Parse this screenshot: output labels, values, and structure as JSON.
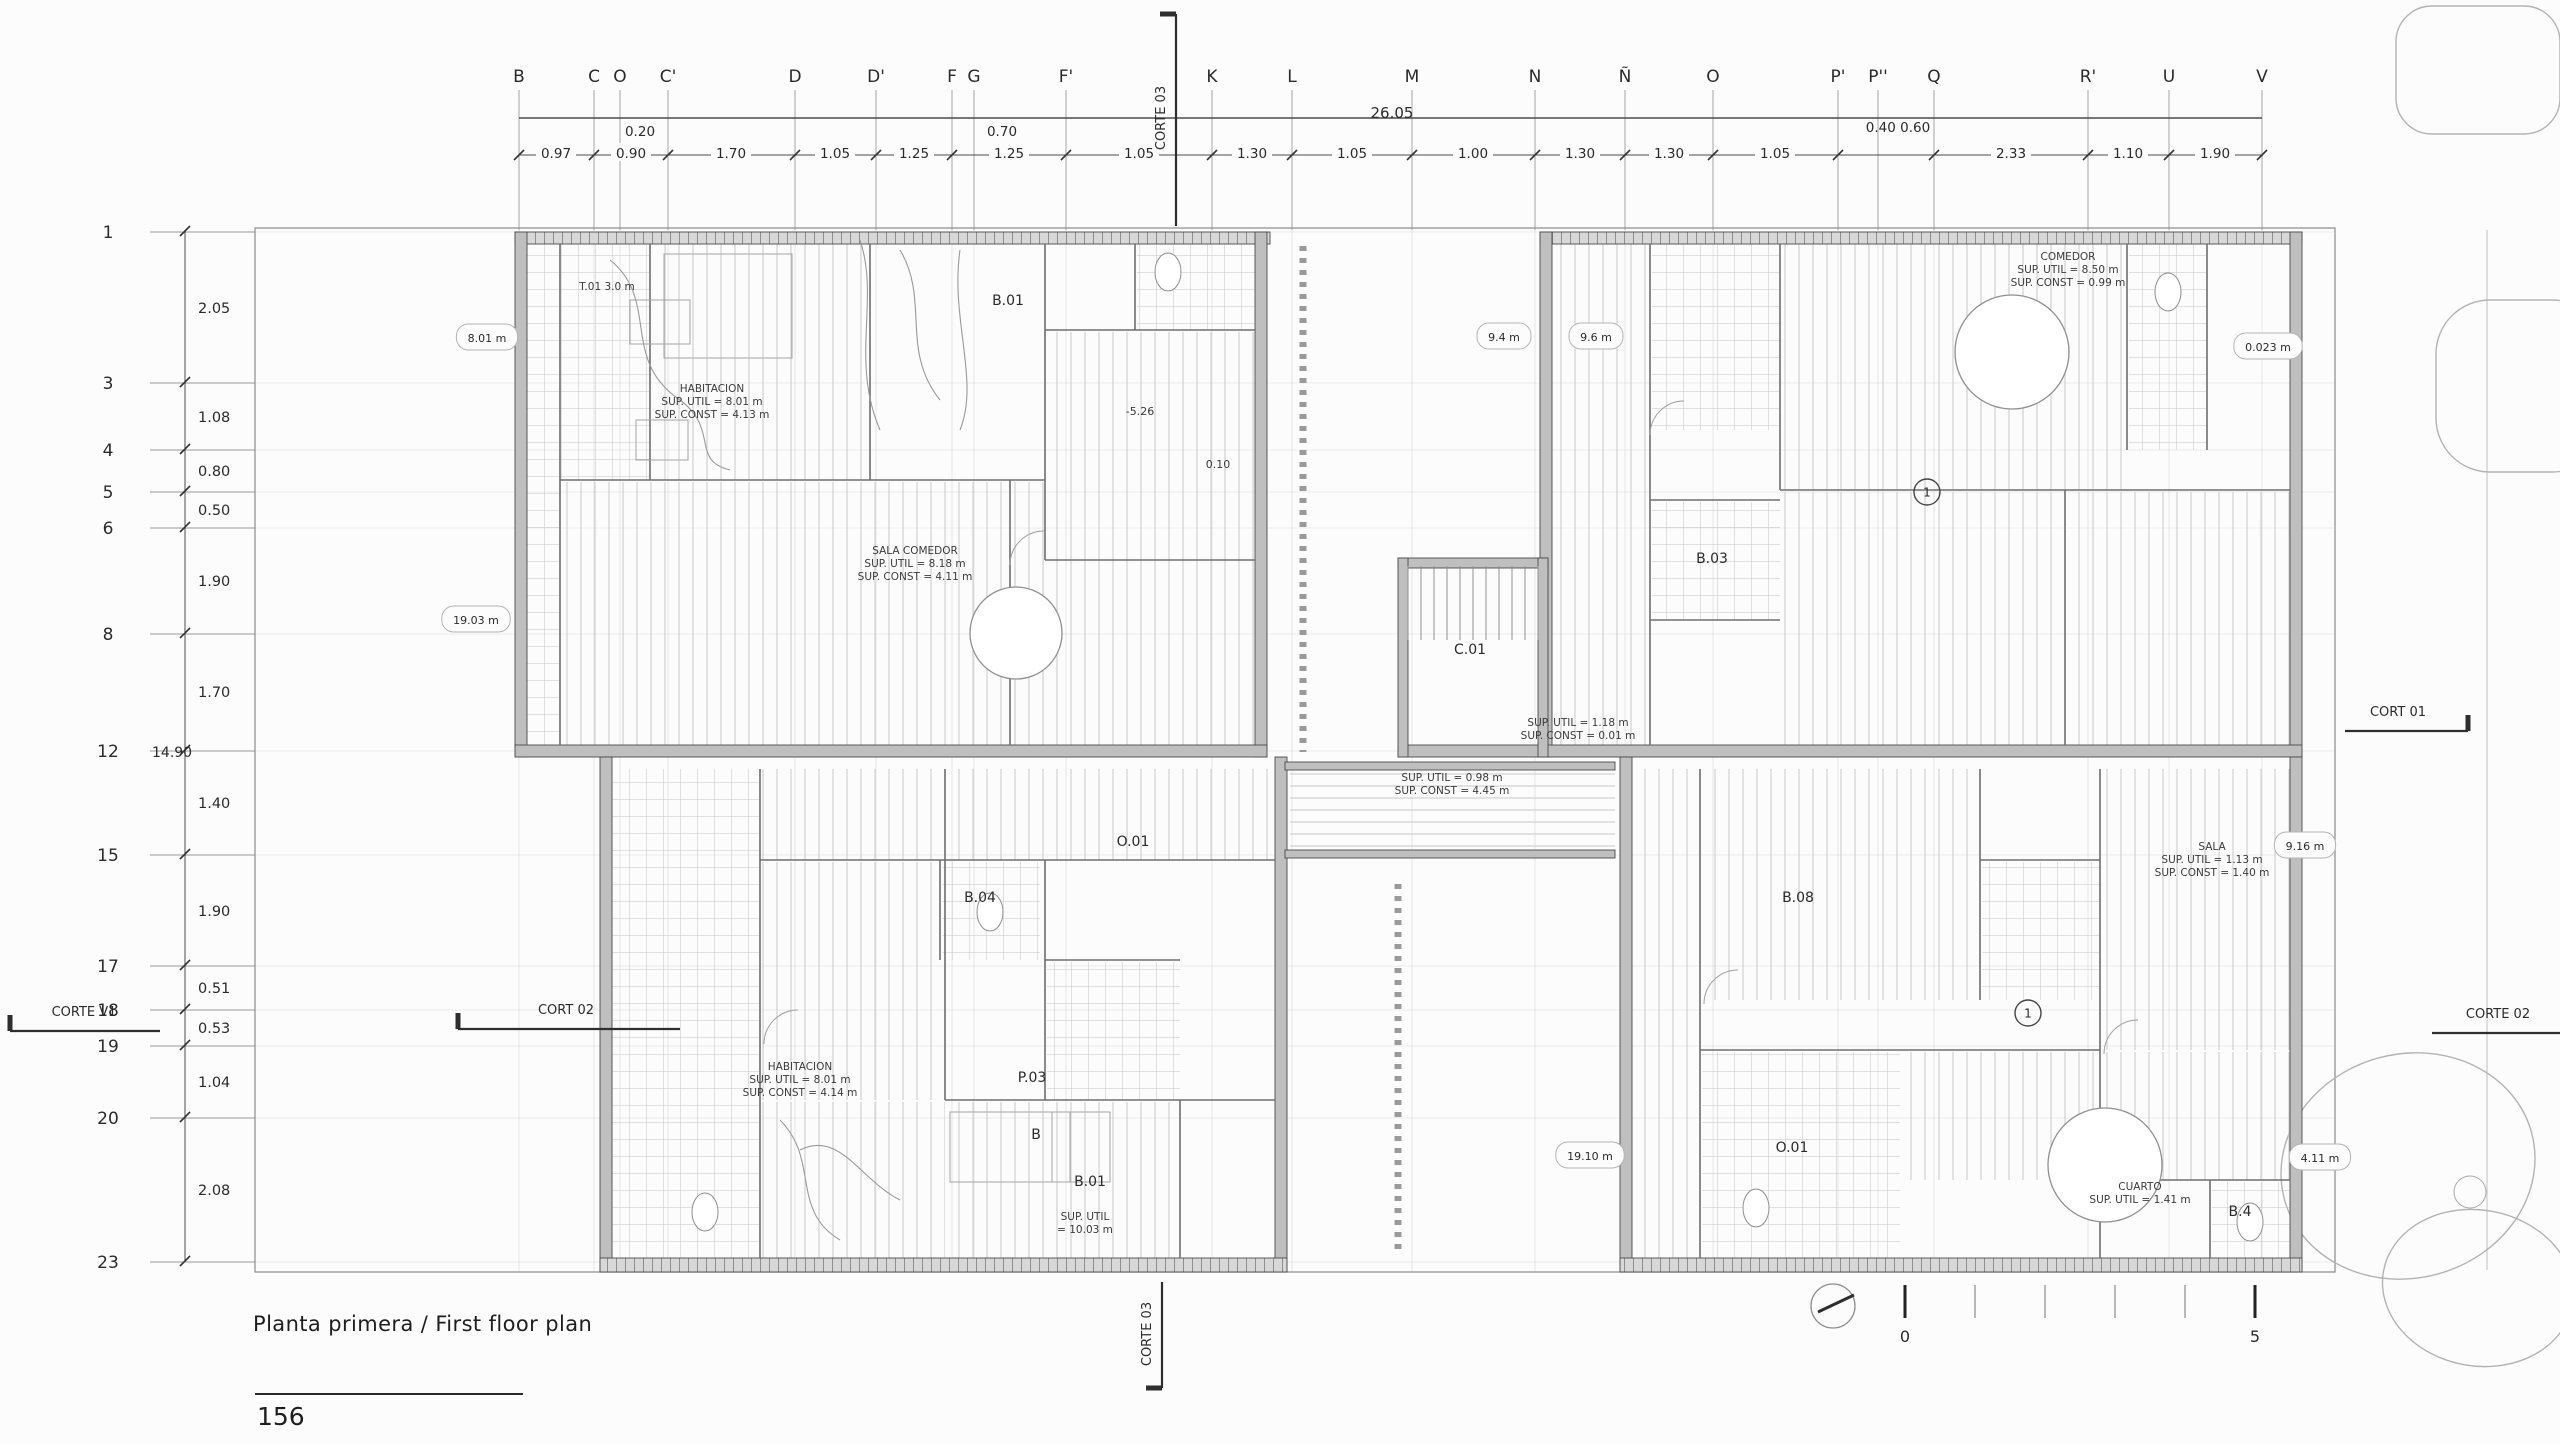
{
  "sheet": {
    "title": "Planta primera / First floor plan",
    "page_number": "156"
  },
  "top_grid": {
    "letters": [
      {
        "label": "B",
        "x": 519
      },
      {
        "label": "C",
        "x": 594
      },
      {
        "label": "O",
        "x": 620
      },
      {
        "label": "C'",
        "x": 668
      },
      {
        "label": "D",
        "x": 795
      },
      {
        "label": "D'",
        "x": 876
      },
      {
        "label": "F",
        "x": 952
      },
      {
        "label": "G",
        "x": 974
      },
      {
        "label": "F'",
        "x": 1066
      },
      {
        "label": "K",
        "x": 1212
      },
      {
        "label": "L",
        "x": 1292
      },
      {
        "label": "M",
        "x": 1412
      },
      {
        "label": "N",
        "x": 1535
      },
      {
        "label": "Ñ",
        "x": 1625
      },
      {
        "label": "O",
        "x": 1713
      },
      {
        "label": "P'",
        "x": 1838
      },
      {
        "label": "P''",
        "x": 1878
      },
      {
        "label": "Q",
        "x": 1934
      },
      {
        "label": "R'",
        "x": 2088
      },
      {
        "label": "U",
        "x": 2169
      },
      {
        "label": "V",
        "x": 2262
      }
    ],
    "total_dim": {
      "text": "26.05",
      "x": 1392,
      "y": 122
    },
    "sub_dims": [
      {
        "text": "0.20",
        "x": 640,
        "y": 136
      },
      {
        "text": "0.70",
        "x": 1002,
        "y": 136
      },
      {
        "text": "0.40 0.60",
        "x": 1898,
        "y": 132
      }
    ],
    "tick_xs": [
      519,
      594,
      668,
      795,
      876,
      952,
      1066,
      1212,
      1292,
      1412,
      1535,
      1625,
      1713,
      1838,
      1934,
      2088,
      2169,
      2262
    ],
    "chain": [
      {
        "text": "0.97",
        "x": 556
      },
      {
        "text": "0.90",
        "x": 631
      },
      {
        "text": "1.70",
        "x": 731
      },
      {
        "text": "1.05",
        "x": 835
      },
      {
        "text": "1.25",
        "x": 914
      },
      {
        "text": "1.25",
        "x": 1009
      },
      {
        "text": "1.05",
        "x": 1139
      },
      {
        "text": "1.30",
        "x": 1252
      },
      {
        "text": "1.05",
        "x": 1352
      },
      {
        "text": "1.00",
        "x": 1473
      },
      {
        "text": "1.30",
        "x": 1580
      },
      {
        "text": "1.30",
        "x": 1669
      },
      {
        "text": "1.05",
        "x": 1775
      },
      {
        "text": "2.33",
        "x": 2011
      },
      {
        "text": "1.10",
        "x": 2128
      },
      {
        "text": "1.90",
        "x": 2215
      }
    ]
  },
  "left_grid": {
    "rows": [
      {
        "label": "1",
        "y": 232
      },
      {
        "label": "3",
        "y": 383
      },
      {
        "label": "4",
        "y": 450
      },
      {
        "label": "5",
        "y": 492
      },
      {
        "label": "6",
        "y": 528
      },
      {
        "label": "8",
        "y": 634
      },
      {
        "label": "12",
        "y": 751
      },
      {
        "label": "15",
        "y": 855
      },
      {
        "label": "17",
        "y": 966
      },
      {
        "label": "18",
        "y": 1010
      },
      {
        "label": "19",
        "y": 1046
      },
      {
        "label": "20",
        "y": 1118
      },
      {
        "label": "23",
        "y": 1262
      }
    ],
    "total": {
      "text": "14.90",
      "x": 152,
      "y": 751
    },
    "dims": [
      {
        "text": "2.05",
        "y": 308
      },
      {
        "text": "1.08",
        "y": 417
      },
      {
        "text": "0.80",
        "y": 471
      },
      {
        "text": "0.50",
        "y": 510
      },
      {
        "text": "1.90",
        "y": 581
      },
      {
        "text": "1.70",
        "y": 692
      },
      {
        "text": "1.40",
        "y": 803
      },
      {
        "text": "1.90",
        "y": 911
      },
      {
        "text": "0.51",
        "y": 988
      },
      {
        "text": "0.53",
        "y": 1028
      },
      {
        "text": "1.04",
        "y": 1082
      },
      {
        "text": "2.08",
        "y": 1190
      }
    ]
  },
  "sections": [
    {
      "id": "corte-03-top",
      "label": "CORTE 03",
      "type": "vertical",
      "x": 1176,
      "y1": 14,
      "y2": 226,
      "tick": "top",
      "tx": 1165,
      "ty": 118
    },
    {
      "id": "corte-03-bottom",
      "label": "CORTE 03",
      "type": "vertical",
      "x": 1162,
      "y1": 1282,
      "y2": 1388,
      "tick": "bottom",
      "tx": 1151,
      "ty": 1334
    },
    {
      "id": "cort-01-right",
      "label": "CORT 01",
      "type": "horizontal",
      "y": 731,
      "x1": 2345,
      "x2": 2468,
      "tick": "right",
      "tx": 2398,
      "ty": 716
    },
    {
      "id": "cort-02-left",
      "label": "CORT 02",
      "type": "horizontal",
      "y": 1029,
      "x1": 458,
      "x2": 680,
      "tick": "left",
      "tx": 566,
      "ty": 1014
    },
    {
      "id": "corte-v1-left",
      "label": "CORTE V1",
      "type": "horizontal",
      "y": 1031,
      "x1": 10,
      "x2": 160,
      "tick": "left",
      "tx": 84,
      "ty": 1016
    },
    {
      "id": "corte-02-right",
      "label": "CORTE 02",
      "type": "horizontal",
      "y": 1033,
      "x1": 2432,
      "x2": 2560,
      "tick": "none",
      "tx": 2498,
      "ty": 1018
    }
  ],
  "annotations": {
    "room_codes": [
      {
        "text": "B.01",
        "x": 1008,
        "y": 305
      },
      {
        "text": "B.03",
        "x": 1712,
        "y": 563
      },
      {
        "text": "C.01",
        "x": 1470,
        "y": 654
      },
      {
        "text": "B.04",
        "x": 980,
        "y": 902
      },
      {
        "text": "O.01",
        "x": 1133,
        "y": 846
      },
      {
        "text": "B.08",
        "x": 1798,
        "y": 902
      },
      {
        "text": "B.01",
        "x": 1090,
        "y": 1186
      },
      {
        "text": "P.03",
        "x": 1032,
        "y": 1082
      },
      {
        "text": "O.01",
        "x": 1792,
        "y": 1152
      },
      {
        "text": "B",
        "x": 1036,
        "y": 1139
      },
      {
        "text": "B.4",
        "x": 2240,
        "y": 1216
      }
    ],
    "room_labels": [
      {
        "x": 712,
        "y": 392,
        "lines": [
          "HABITACION",
          "SUP. UTIL = 8.01 m",
          "SUP. CONST = 4.13 m"
        ]
      },
      {
        "x": 915,
        "y": 554,
        "lines": [
          "SALA COMEDOR",
          "SUP. UTIL = 8.18 m",
          "SUP. CONST = 4.11 m"
        ]
      },
      {
        "x": 1452,
        "y": 781,
        "lines": [
          "SUP. UTIL = 0.98 m",
          "SUP. CONST = 4.45 m"
        ]
      },
      {
        "x": 2068,
        "y": 260,
        "lines": [
          "COMEDOR",
          "SUP. UTIL = 8.50 m",
          "SUP. CONST = 0.99 m"
        ]
      },
      {
        "x": 2212,
        "y": 850,
        "lines": [
          "SALA",
          "SUP. UTIL = 1.13 m",
          "SUP. CONST = 1.40 m"
        ]
      },
      {
        "x": 800,
        "y": 1070,
        "lines": [
          "HABITACION",
          "SUP. UTIL = 8.01 m",
          "SUP. CONST = 4.14 m"
        ]
      },
      {
        "x": 1578,
        "y": 726,
        "lines": [
          "SUP. UTIL = 1.18 m",
          "SUP. CONST = 0.01 m"
        ]
      },
      {
        "x": 2140,
        "y": 1190,
        "lines": [
          "CUARTO",
          "SUP. UTIL = 1.41 m"
        ]
      },
      {
        "x": 1085,
        "y": 1220,
        "lines": [
          "SUP. UTIL",
          "= 10.03 m"
        ]
      },
      {
        "x": 607,
        "y": 290,
        "lines": [
          "T.01 3.0 m"
        ]
      }
    ],
    "pills": [
      {
        "text": "8.01 m",
        "x": 487,
        "y": 338
      },
      {
        "text": "19.03 m",
        "x": 476,
        "y": 620
      },
      {
        "text": "9.4 m",
        "x": 1504,
        "y": 337
      },
      {
        "text": "9.6 m",
        "x": 1596,
        "y": 337
      },
      {
        "text": "9.16 m",
        "x": 2305,
        "y": 846
      },
      {
        "text": "4.11 m",
        "x": 2320,
        "y": 1158
      },
      {
        "text": "19.10 m",
        "x": 1590,
        "y": 1156
      },
      {
        "text": "0.023 m",
        "x": 2268,
        "y": 347
      }
    ],
    "levels": [
      {
        "text": "-5.26",
        "x": 1140,
        "y": 415
      },
      {
        "text": "0.10",
        "x": 1218,
        "y": 468
      }
    ],
    "circled_marks": [
      {
        "text": "1",
        "x": 1927,
        "y": 492
      },
      {
        "text": "1",
        "x": 2028,
        "y": 1013
      }
    ]
  },
  "scale_bar": {
    "zero_label": "0",
    "five_label": "5"
  },
  "colors": {
    "ink": "#2a2a2a",
    "line": "#6f6f6f",
    "faint": "#bdbdbd",
    "hatch": "#c7c7c7",
    "wall": "#bfbfbf",
    "wall_dark": "#4a4a4a",
    "sketch": "#9a9a9a"
  }
}
